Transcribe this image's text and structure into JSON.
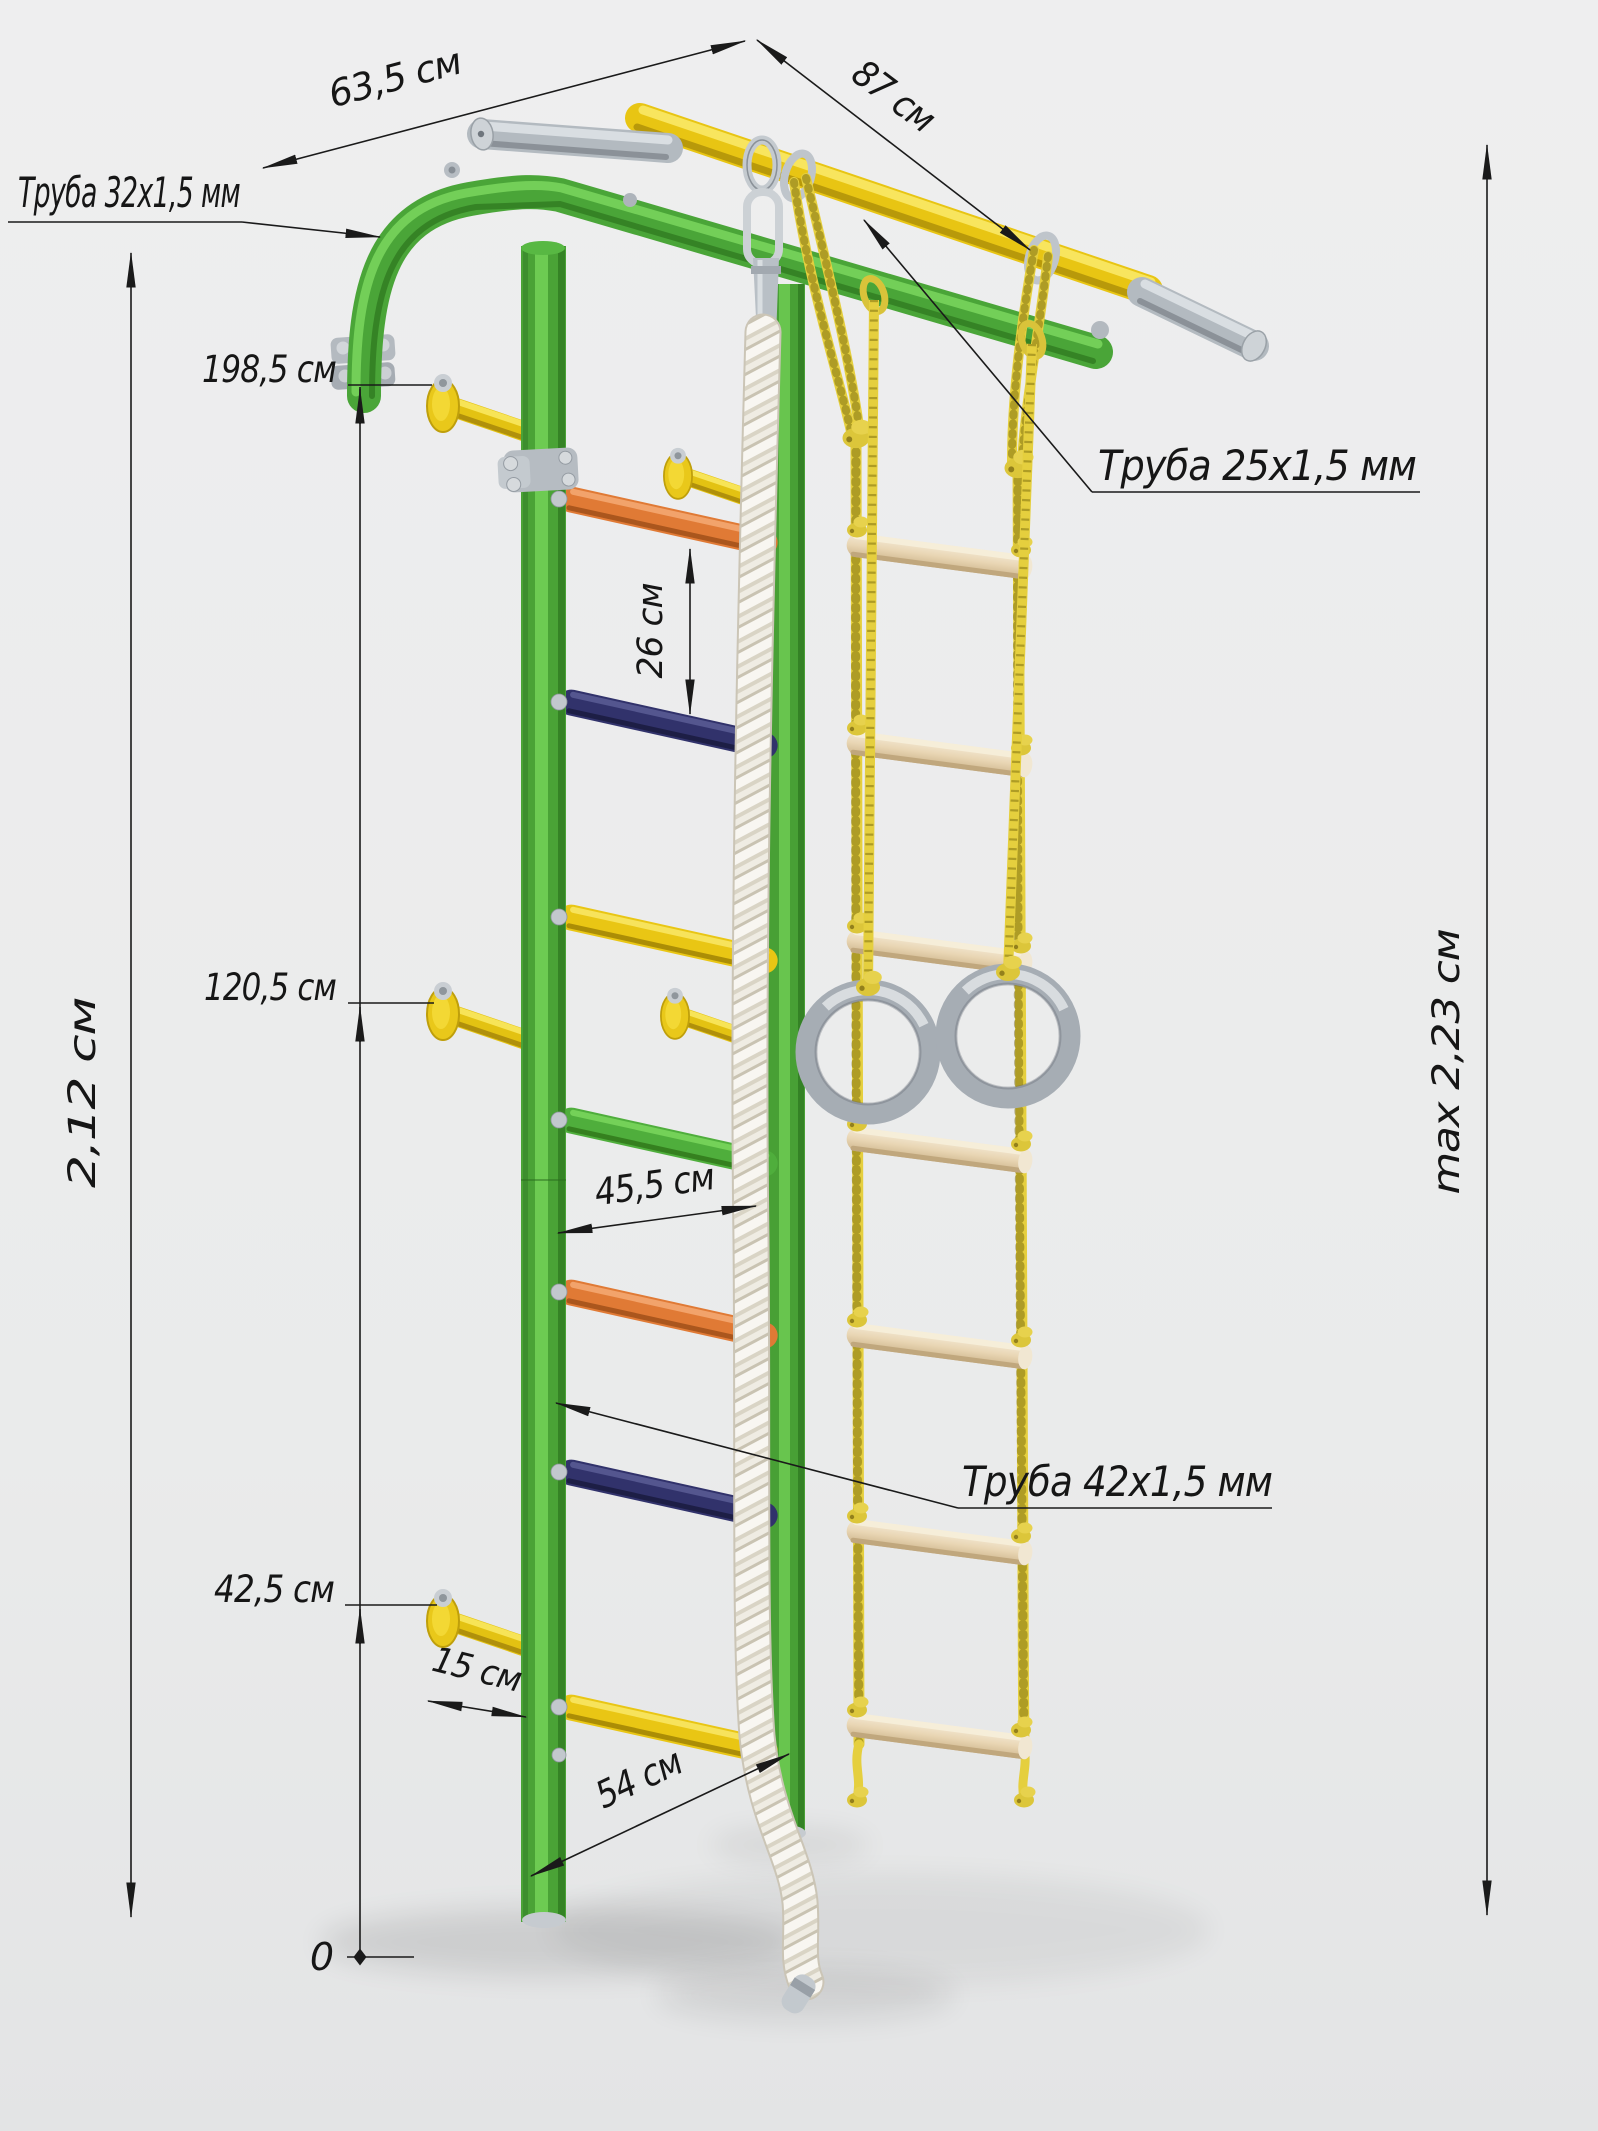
{
  "title": "Wall bars (Swedish wall) dimensioned product illustration",
  "annotations": {
    "tube_top": "Труба 32x1,5 мм",
    "tube_rung": "Труба 25x1,5 мм",
    "tube_post": "Труба 42x1,5 мм",
    "depth_top": "63,5 см",
    "width_top": "87 см",
    "height_upper_bracket": "198,5 см",
    "height_middle_bracket": "120,5 см",
    "height_lower_bracket": "42,5 см",
    "rung_spacing": "26 см",
    "ladder_inner_width": "45,5 см",
    "bracket_depth": "15 см",
    "base_depth": "54 см",
    "total_height": "2,12 см",
    "max_height": "max 2,23 см",
    "zero_level": "0"
  },
  "palette": {
    "background": "#ececec",
    "frame_green": "#4aa538",
    "accent_yellow": "#e8c513",
    "rung_orange": "#e07a35",
    "rung_navy": "#31326b",
    "wood_rung": "#e9d6b4",
    "metal_gray": "#b6bcc2",
    "climb_rope_white": "#f2efe7",
    "rope_yellow": "#e0ca3e",
    "ring_gray": "#a6adb4",
    "dimension_ink": "#1a1a1a"
  },
  "parts": [
    "wall-mounted green frame",
    "yellow pull-up bar",
    "gray handles",
    "colored ladder rungs",
    "white climbing rope",
    "yellow rope ladder with wooden rungs",
    "gymnastic rings",
    "wall mounting brackets"
  ]
}
